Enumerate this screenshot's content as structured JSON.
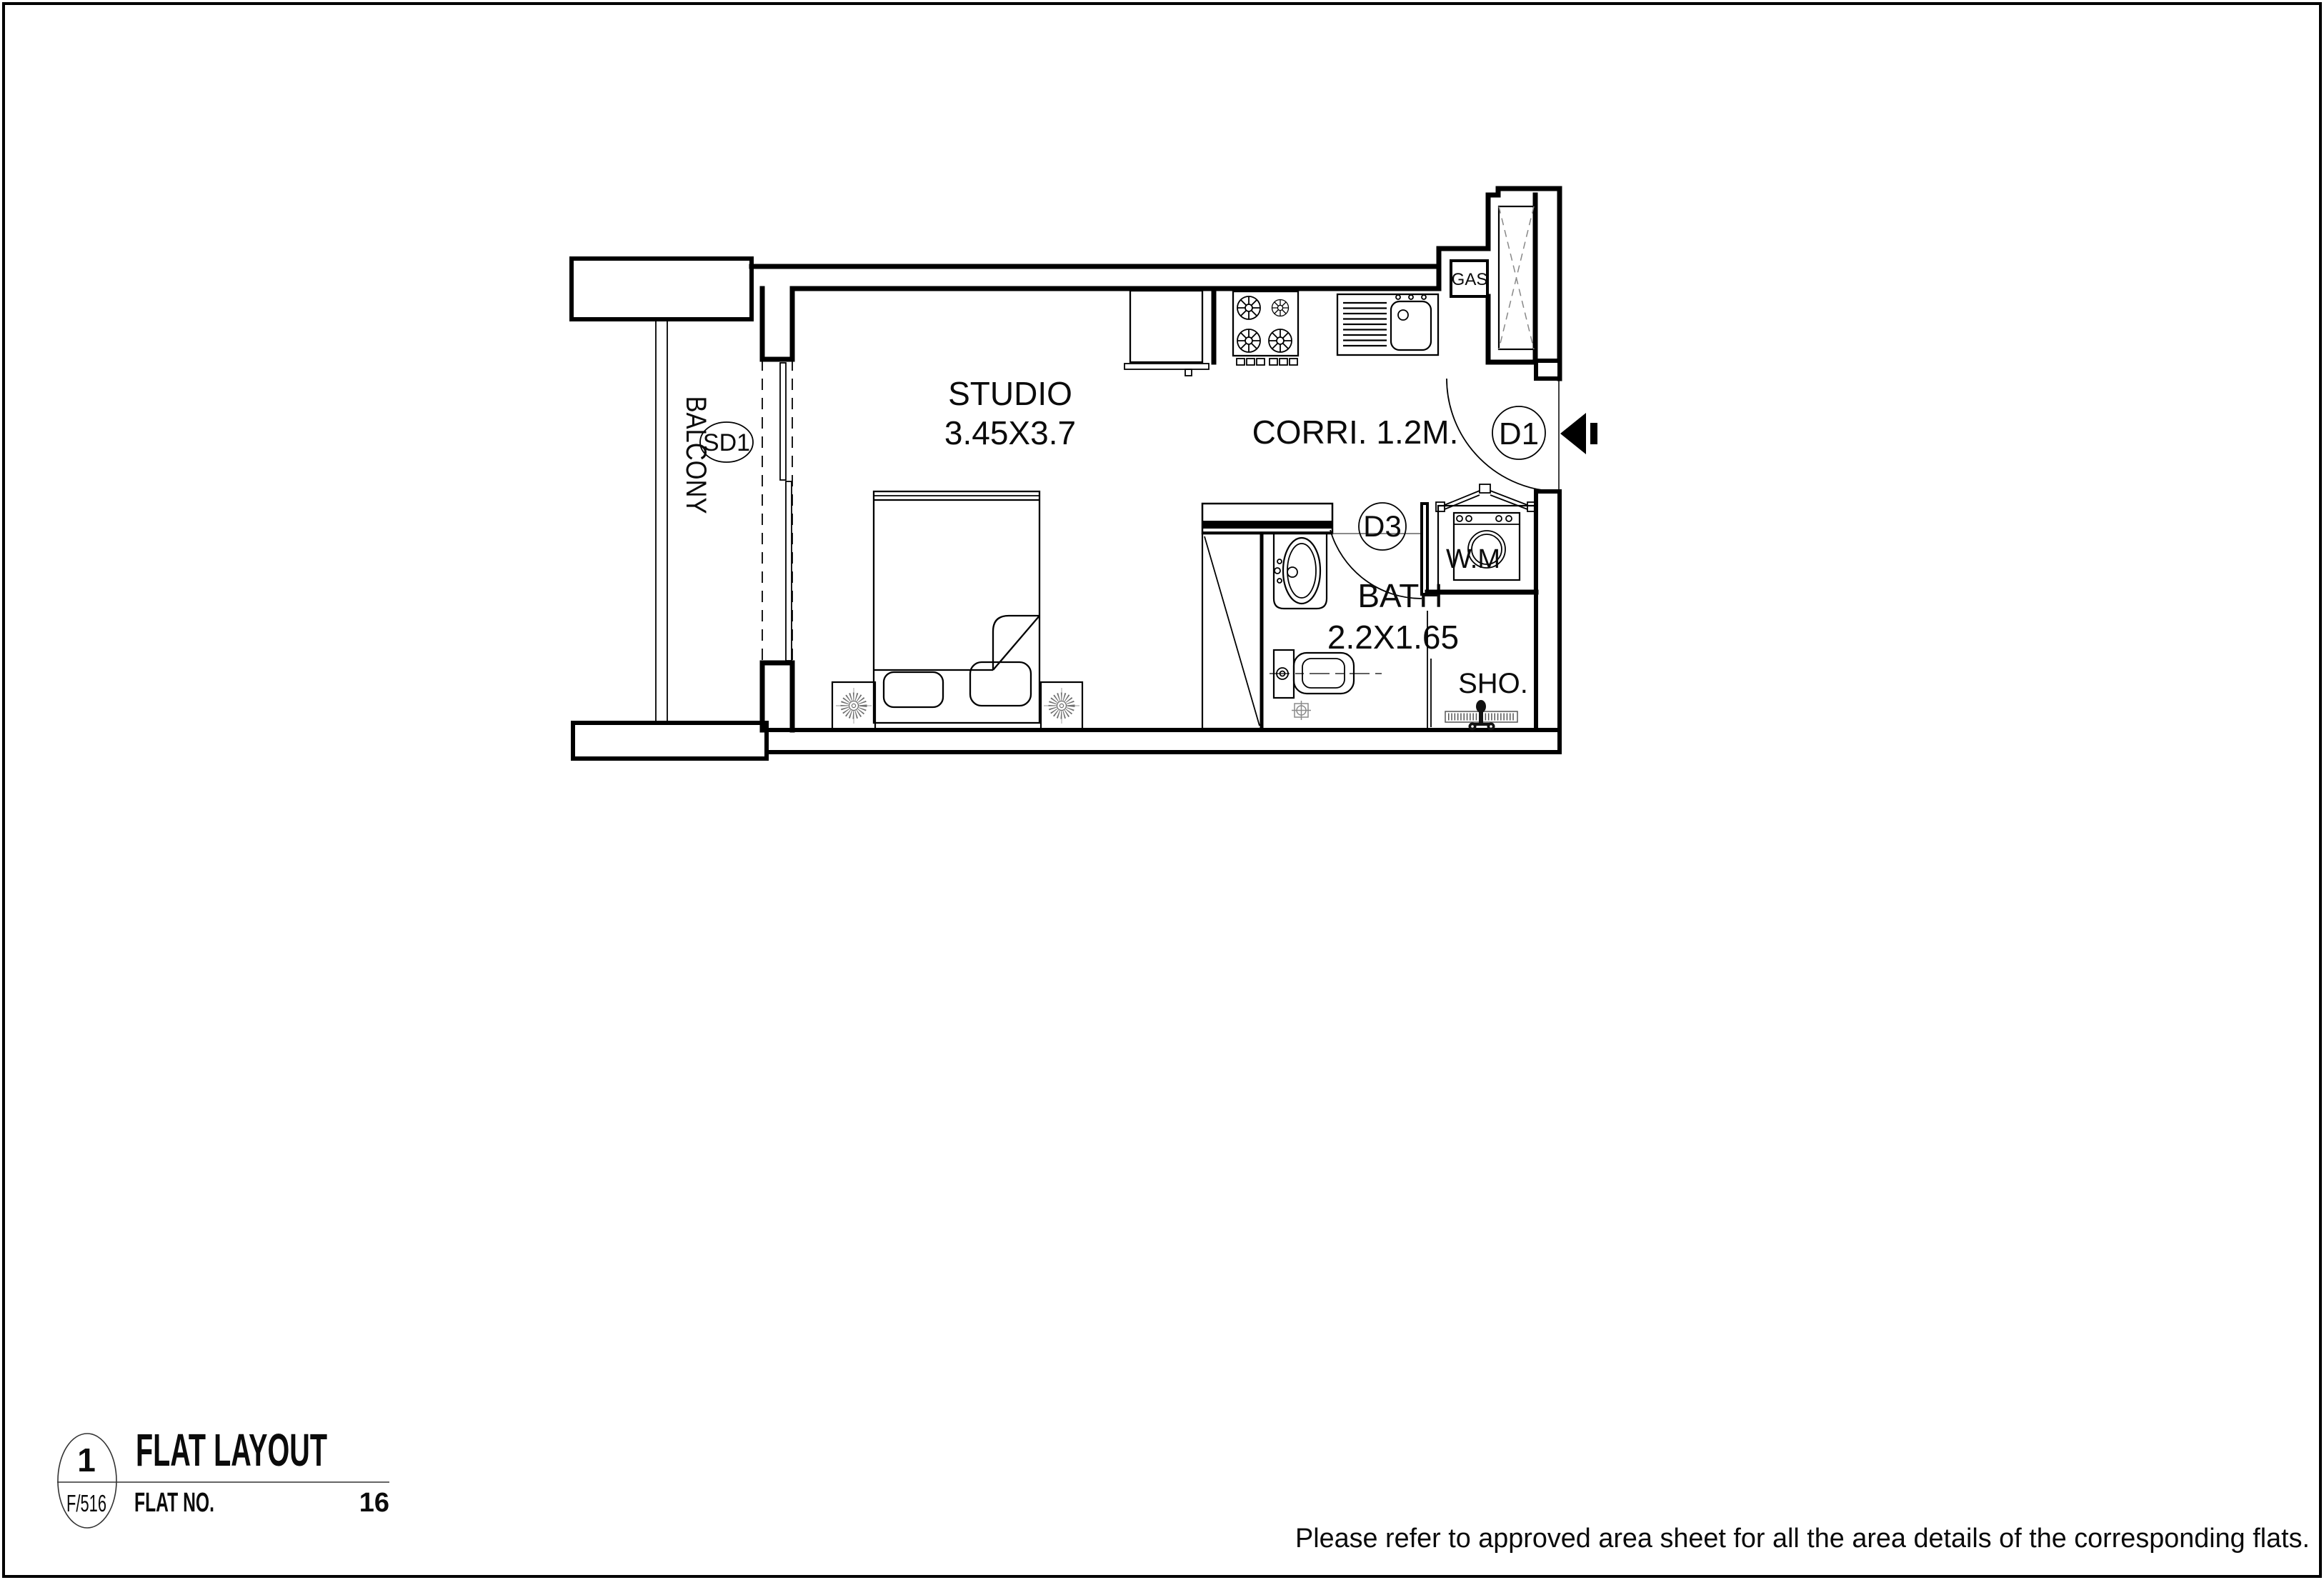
{
  "plan": {
    "rooms": {
      "studio": {
        "name": "STUDIO",
        "dims": "3.45X3.7"
      },
      "balcony": {
        "name": "BALCONY"
      },
      "corridor": {
        "name": "CORRI. 1.2M."
      },
      "bath": {
        "name": "BATH",
        "dims": "2.2X1.65"
      },
      "shower": {
        "name": "SHO."
      }
    },
    "tags": {
      "entry_door": "D1",
      "bath_door": "D3",
      "sliding_door": "SD1",
      "gas_meter": "GAS",
      "washing_machine": "W.M"
    }
  },
  "title_block": {
    "detail_number": "1",
    "sheet_ref": "F/516",
    "title": "FLAT LAYOUT",
    "flat_no_label": "FLAT NO.",
    "flat_no_value": "16"
  },
  "page": {
    "footnote": "Please refer to approved area sheet for all the area details of the corresponding flats."
  }
}
